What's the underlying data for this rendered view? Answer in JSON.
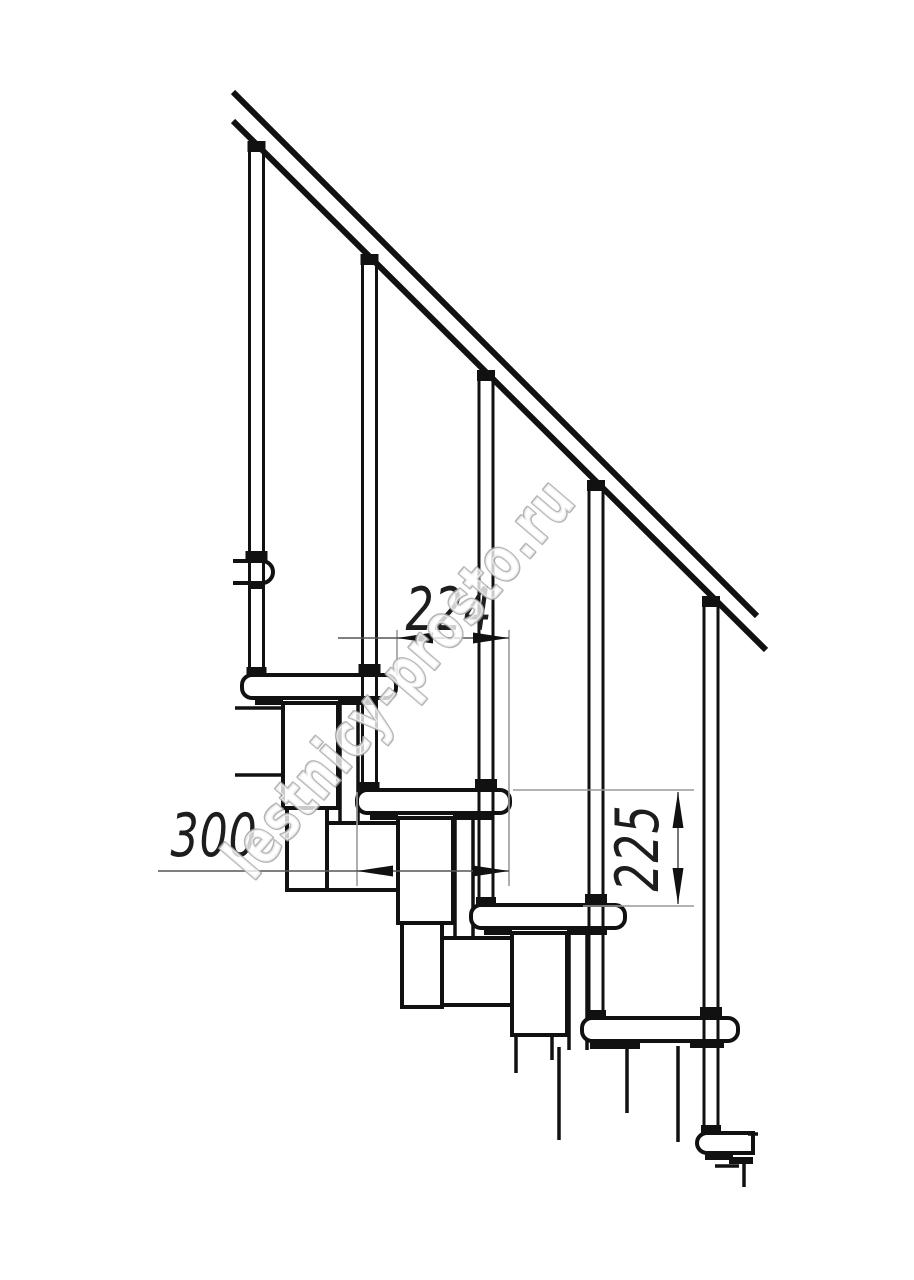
{
  "page": {
    "background_color": "#ffffff"
  },
  "watermark": {
    "text": "lestnicy-prosto.ru",
    "outline_color": "#a8a8a8"
  },
  "drawing": {
    "kind": "modular-staircase side-view technical drawing fragment",
    "line_color": "#111111",
    "dimensions": [
      {
        "id": "going",
        "label": "224",
        "orientation": "horizontal",
        "meaning": "horizontal distance between tread noses"
      },
      {
        "id": "tread-length",
        "label": "300",
        "orientation": "horizontal",
        "meaning": "tread depth"
      },
      {
        "id": "rise",
        "label": "225",
        "orientation": "vertical",
        "meaning": "step rise height"
      }
    ],
    "components": {
      "handrail_angle_deg": 45,
      "baluster_count": 5,
      "tread_count": 5,
      "upper_tread_fragment": 1,
      "module_chain": "zig-zag rectangular modules under treads"
    }
  }
}
